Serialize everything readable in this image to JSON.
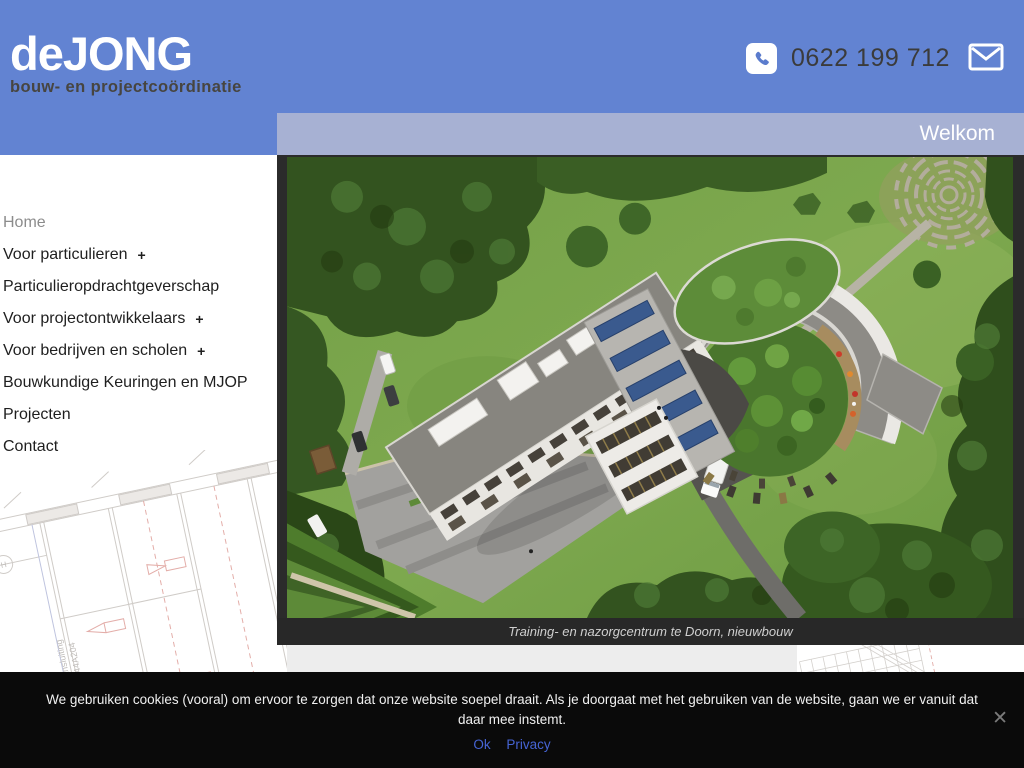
{
  "header": {
    "logo_title": "deJONG",
    "logo_subtitle": "bouw- en projectcoördinatie",
    "phone_number": "0622 199 712",
    "phone_icon": "phone-icon",
    "mail_icon": "envelope-icon"
  },
  "banner": {
    "title": "Welkom"
  },
  "nav": {
    "items": [
      {
        "label": "Home",
        "suffix": "",
        "state": "active"
      },
      {
        "label": "Voor particulieren",
        "suffix": "+"
      },
      {
        "label": "Particulieropdrachtgeverschap",
        "suffix": ""
      },
      {
        "label": "Voor projectontwikkelaars",
        "suffix": "+"
      },
      {
        "label": "Voor bedrijven en scholen",
        "suffix": "+"
      },
      {
        "label": "Bouwkundige Keuringen en MJOP",
        "suffix": ""
      },
      {
        "label": "Projecten",
        "suffix": ""
      },
      {
        "label": "Contact",
        "suffix": ""
      }
    ]
  },
  "main": {
    "photo_caption": "Training- en nazorgcentrum te Doorn, nieuwbouw",
    "photo_subject": "aerial-render-training-nazorgcentrum"
  },
  "background_drawing": {
    "note_line1": "voor aansluiting",
    "note_line2": "zie: 5544A204",
    "grid_label": "H"
  },
  "cookie_banner": {
    "message": "We gebruiken cookies (vooral) om ervoor te zorgen dat onze website soepel draait. Als je doorgaat met het gebruiken van de website, gaan we er vanuit dat daar mee instemt.",
    "ok_label": "Ok",
    "privacy_label": "Privacy",
    "close_symbol": "✕"
  },
  "colors": {
    "header_blue": "#6283d2",
    "welkom_bar": "#a7b1d3",
    "link_blue": "#4664d4",
    "caption_bg": "#282828",
    "cookie_bg": "#0a0a0a",
    "content_gray": "#ededed"
  }
}
